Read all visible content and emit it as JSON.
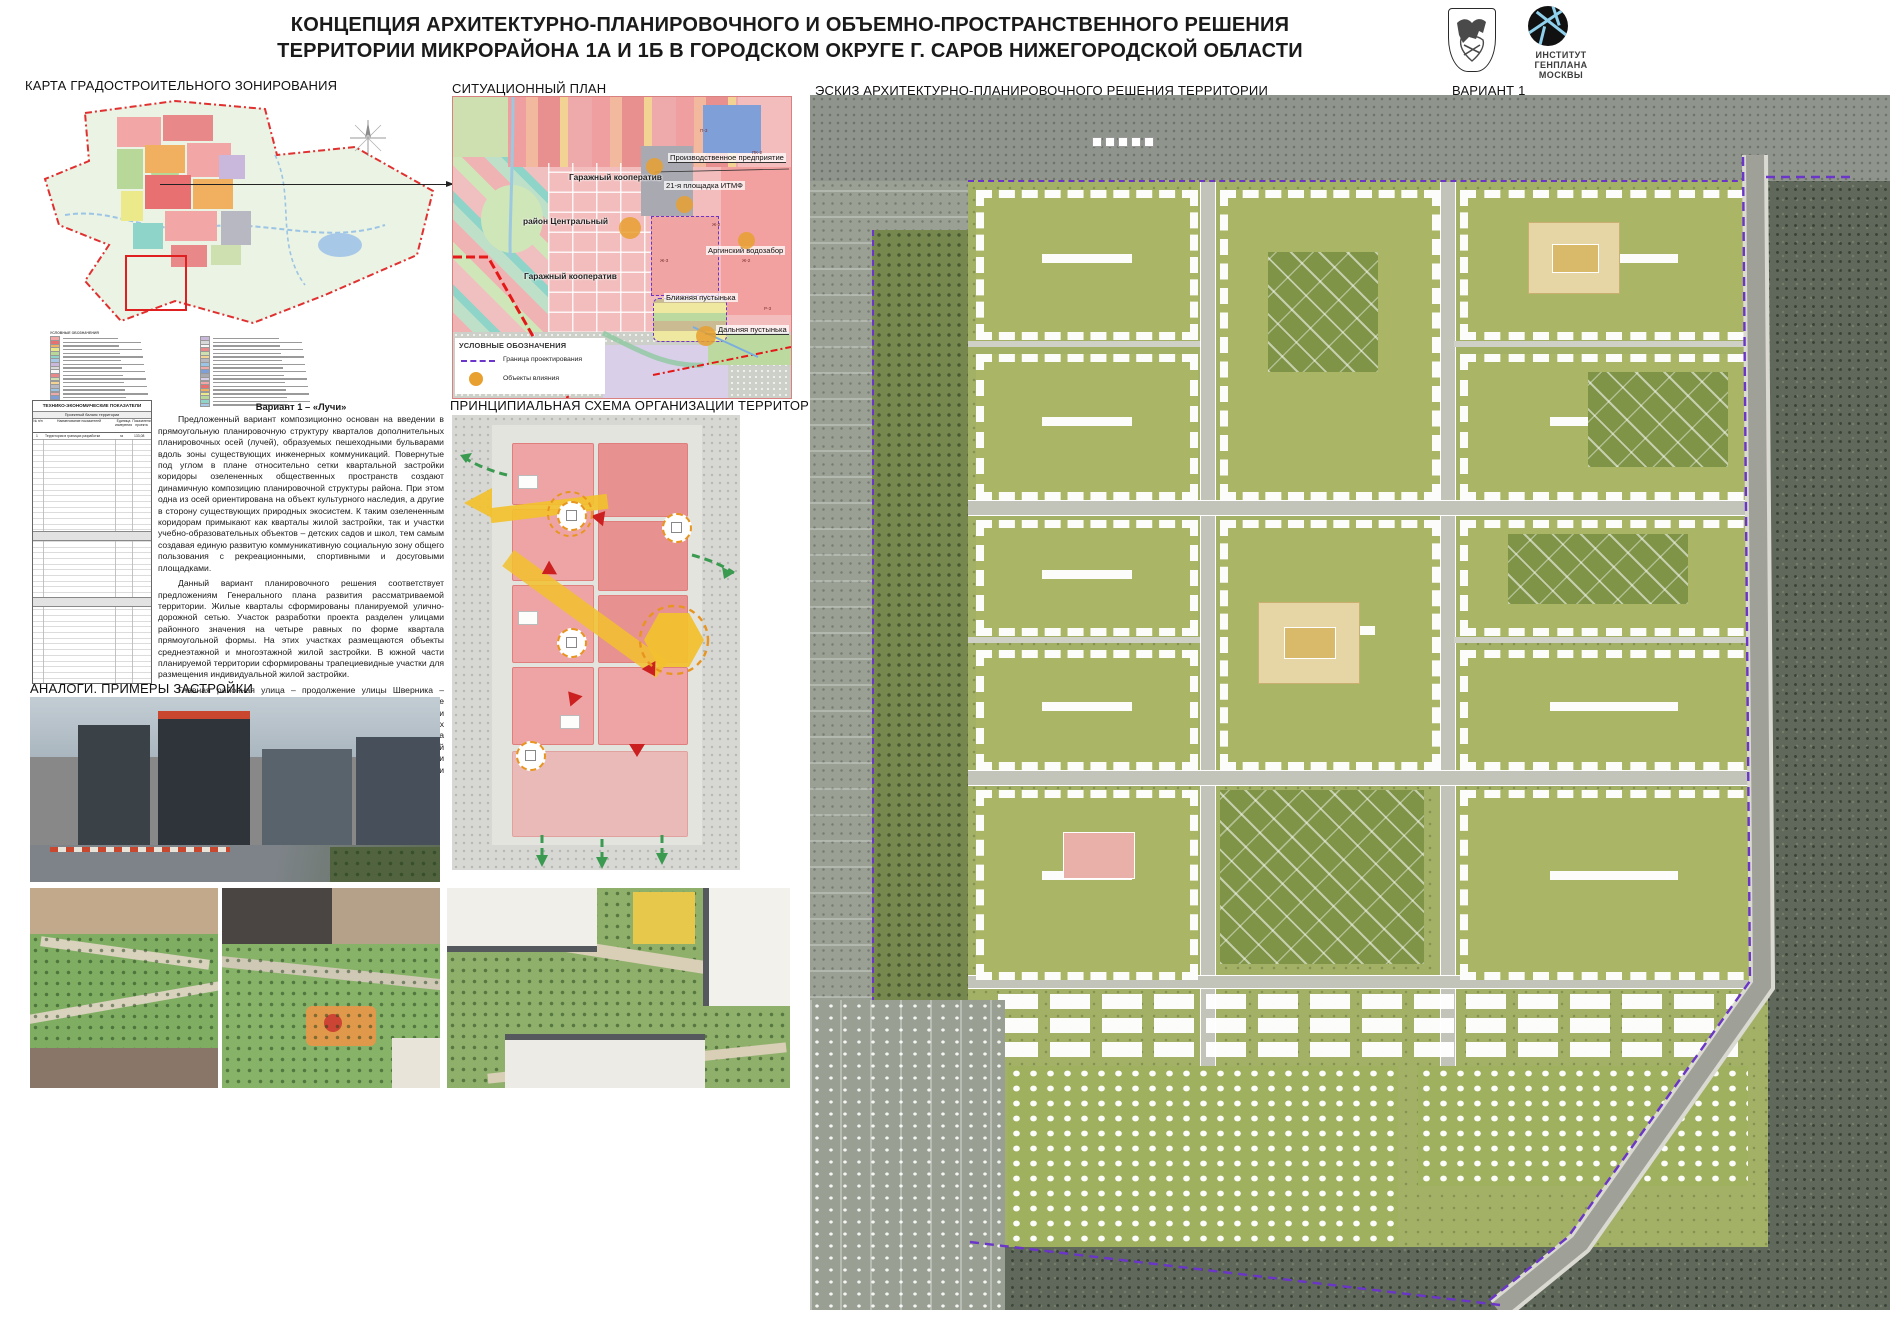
{
  "header": {
    "title_line1": "КОНЦЕПЦИЯ АРХИТЕКТУРНО-ПЛАНИРОВОЧНОГО И ОБЪЕМНО-ПРОСТРАНСТВЕННОГО РЕШЕНИЯ",
    "title_line2": "ТЕРРИТОРИИ МИКРОРАЙОНА 1А И 1Б В ГОРОДСКОМ ОКРУГЕ Г. САРОВ НИЖЕГОРОДСКОЙ ОБЛАСТИ",
    "institute_logo": {
      "line1": "ИНСТИТУТ",
      "line2": "ГЕНПЛАНА",
      "line3": "МОСКВЫ"
    }
  },
  "sections": {
    "zoning_map": "КАРТА ГРАДОСТРОИТЕЛЬНОГО ЗОНИРОВАНИЯ",
    "situation_plan": "СИТУАЦИОННЫЙ ПЛАН",
    "sketch": "ЭСКИЗ АРХИТЕКТУРНО-ПЛАНИРОВОЧНОГО РЕШЕНИЯ ТЕРРИТОРИИ",
    "variant": "ВАРИАНТ 1",
    "schema": "ПРИНЦИПИАЛЬНАЯ СХЕМА ОРГАНИЗАЦИИ ТЕРРИТОРИИ",
    "analogs": "АНАЛОГИ. ПРИМЕРЫ ЗАСТРОЙКИ"
  },
  "situation_plan": {
    "labels": {
      "garage_coop_north": "Гаражный кооператив",
      "district_central": "район Центральный",
      "garage_coop_south": "Гаражный кооператив"
    },
    "callouts": [
      {
        "label": "Производственное предприятие"
      },
      {
        "label": "21-я площадка ИТМФ"
      },
      {
        "label": "Аргинский водозабор"
      },
      {
        "label": "Ближняя пустынька"
      },
      {
        "label": "Дальняя пустынька"
      }
    ],
    "zone_codes": [
      {
        "code": "Ж-2"
      },
      {
        "code": "Ж-2"
      },
      {
        "code": "ПК-2"
      },
      {
        "code": "Р-3"
      },
      {
        "code": "П-3"
      },
      {
        "code": "Ж-3"
      }
    ],
    "legend": {
      "title": "УСЛОВНЫЕ ОБОЗНАЧЕНИЯ",
      "items": [
        {
          "label": "Граница проектирования"
        },
        {
          "label": "Объекты влияния"
        }
      ]
    }
  },
  "tep_table": {
    "title": "ТЕХНИКО-ЭКОНОМИЧЕСКИЕ ПОКАЗАТЕЛИ",
    "section1": "Проектный баланс территории",
    "columns": {
      "num": "№ п/п",
      "name": "Наименование показателей",
      "unit": "Единица измерения",
      "value": "Показатели проекта"
    },
    "row1": {
      "num": "1",
      "name": "Территория в границах разработки",
      "unit": "га",
      "value": "133,08"
    }
  },
  "variant_text": {
    "heading": "Вариант 1 – «Лучи»",
    "p1": "Предложенный вариант композиционно основан на введении в прямоугольную планировочную структуру кварталов дополнительных планировочных осей (лучей), образуемых пешеходными бульварами вдоль зоны существующих инженерных коммуникаций. Повернутые под углом в плане относительно сетки квартальной застройки коридоры озелененных общественных пространств создают динамичную композицию планировочной структуры района. При этом одна из осей ориентирована на объект культурного наследия, а другие в сторону существующих природных экосистем. К таким озелененным коридорам примыкают как кварталы жилой застройки, так и участки учебно-образовательных объектов – детских садов и школ, тем самым создавая единую развитую коммуникативную социальную зону общего пользования с рекреационными, спортивными и досуговыми площадками.",
    "p2": "Данный вариант планировочного решения соответствует предложениям Генерального плана развития рассматриваемой территории. Жилые кварталы сформированы планируемой улично-дорожной сетью. Участок разработки проекта разделен улицами районного значения на четыре равных по форме квартала прямоугольной формы. На этих участках размещаются объекты среднеэтажной и многоэтажной жилой застройки. В южной части планируемой территории сформированы трапециевидные участки для размещения индивидуальной жилой застройки.",
    "p3": "Главная районная улица – продолжение улицы Шверника – разделяет район в направлении восток-запад. Вдоль нее предполагается создать линейную застройку с высотными доминантами и развитой общественно-деловой функцией в первых нежилых этажах. В северо-западной и центральной частях района располагаются объекты общественной и торгово-развлекательной инфраструктуры. Эти объекты расположены на узловых точках сети пешеходных маршрутов, что повышает их привлекательность и эффективность функционирования."
  },
  "colors": {
    "boundary_red": "#e02020",
    "boundary_purple": "#6a35c8",
    "influence_orange": "#e8a030",
    "logo_blue": "#8fd0ec"
  }
}
